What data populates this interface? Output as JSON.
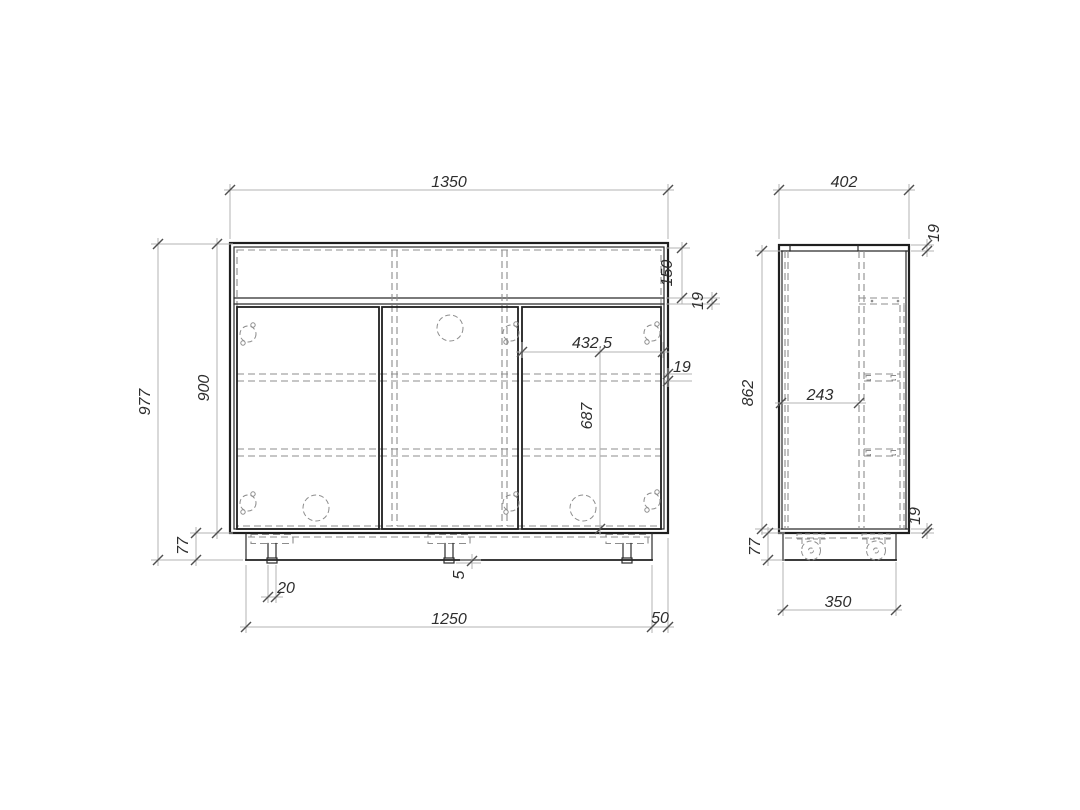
{
  "document": {
    "kind": "furniture technical drawing",
    "views": [
      "front elevation",
      "side section"
    ],
    "background_color": "#ffffff",
    "outline_color": "#1f1f1f",
    "hidden_line_color": "#8d8d8d",
    "dimension_line_color": "#b3b3b3",
    "dimension_text_color": "#2e2e2e"
  },
  "views": {
    "front": {
      "label": "front-view",
      "dimensions": {
        "overall_width": "1350",
        "overall_height": "977",
        "carcass_height": "900",
        "top_niche_height": "150",
        "top_rail_thickness": "19",
        "right_door_width": "432.5",
        "shelf_thickness": "19",
        "door_height": "687",
        "plinth_height": "77",
        "foot_width": "20",
        "foot_protrusion": "5",
        "plinth_width": "1250",
        "plinth_side_offset": "50"
      }
    },
    "side": {
      "label": "side-view",
      "dimensions": {
        "overall_depth": "402",
        "top_panel_thickness": "19",
        "internal_height": "862",
        "partition_depth": "243",
        "bottom_panel_thickness": "19",
        "plinth_height": "77",
        "plinth_depth": "350"
      }
    }
  }
}
